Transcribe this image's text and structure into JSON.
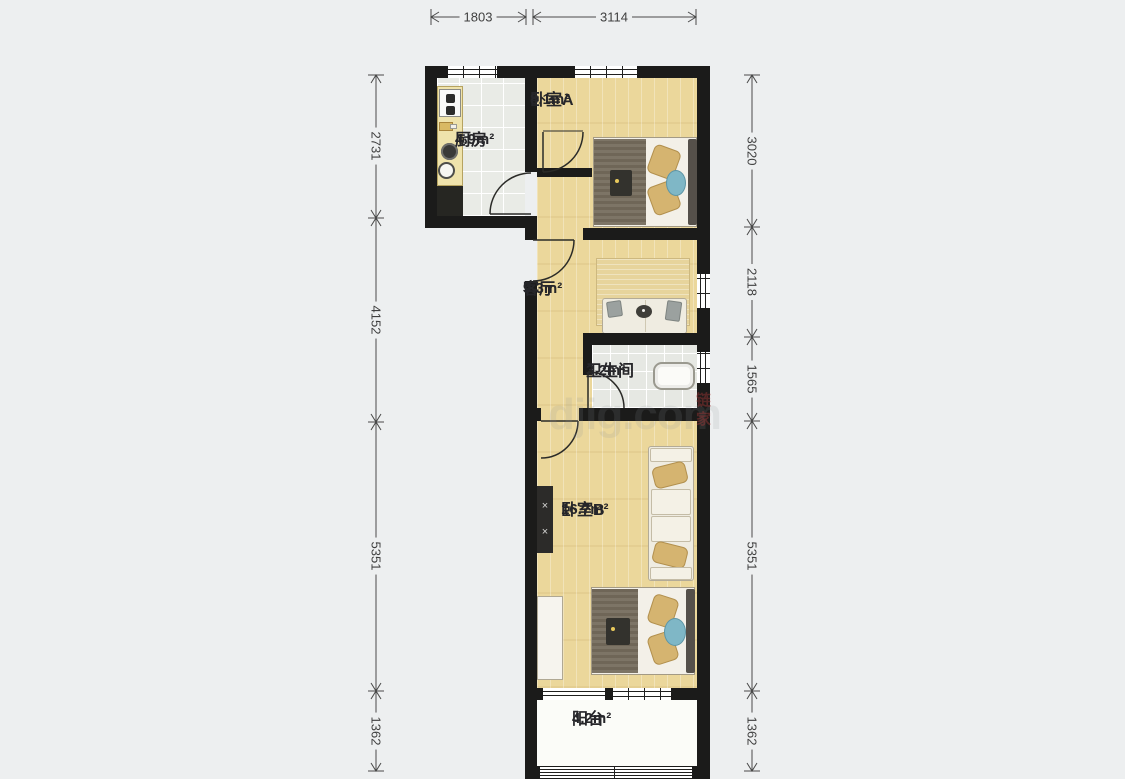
{
  "floorplan": {
    "rooms": {
      "kitchen": {
        "name": "厨房",
        "area": "4.9m²"
      },
      "bedroom_a": {
        "name": "卧室A",
        "area": "8.1m²"
      },
      "living": {
        "name": "客厅",
        "area": "9.3m²"
      },
      "bathroom": {
        "name": "卫生间",
        "area": "3.2m²"
      },
      "bedroom_b": {
        "name": "卧室B",
        "area": "16.7m²"
      },
      "balcony": {
        "name": "阳台",
        "area": "4.2m²"
      }
    },
    "dimensions_mm": {
      "top": [
        "1803",
        "3114"
      ],
      "left": [
        "2731",
        "4152",
        "5351",
        "1362"
      ],
      "right": [
        "3020",
        "2118",
        "1565",
        "5351",
        "1362"
      ]
    },
    "watermark": {
      "text": "djig.com",
      "stamp": "链家"
    },
    "colors": {
      "wall": "#1b1b1a",
      "wood_floor": "#ebd79b",
      "tile_floor": "#e9ebe6",
      "balcony_floor": "#fbfcf8",
      "bed_blanket": "#756c5c",
      "pillow_tan": "#d5b470",
      "accent_teal": "#7fb7c6",
      "background": "#edeff0",
      "dimension_line": "#4a4a4a"
    }
  }
}
